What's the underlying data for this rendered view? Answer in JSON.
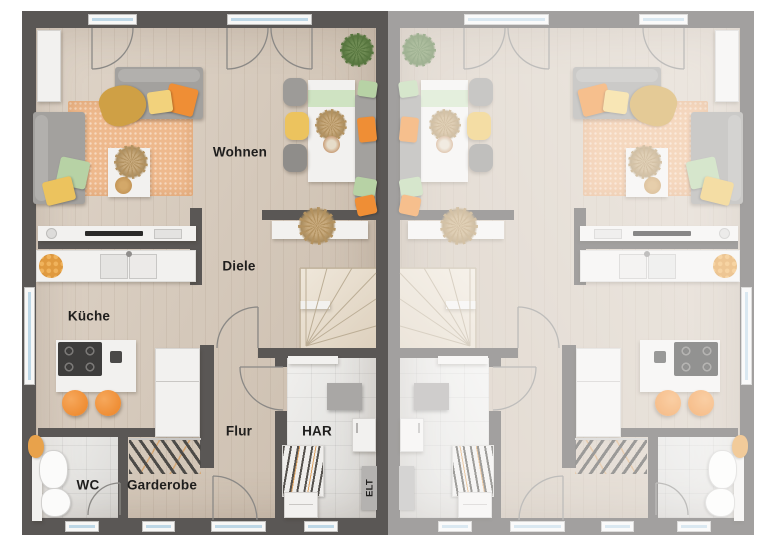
{
  "rooms": {
    "wohnen": "Wohnen",
    "diele": "Diele",
    "kueche": "Küche",
    "flur": "Flur",
    "har": "HAR",
    "wc": "WC",
    "garderobe": "Garderobe",
    "elt": "ELT"
  },
  "colors": {
    "wall": "#5a5755",
    "floor": "#d7cabb",
    "floor_tile": "#e8e7e4",
    "rug": "#eeb98d",
    "orange": "#ef8e35",
    "yellow": "#ecc35e",
    "green": "#b7d2a5",
    "fade": "rgba(255,255,255,0.44)"
  }
}
